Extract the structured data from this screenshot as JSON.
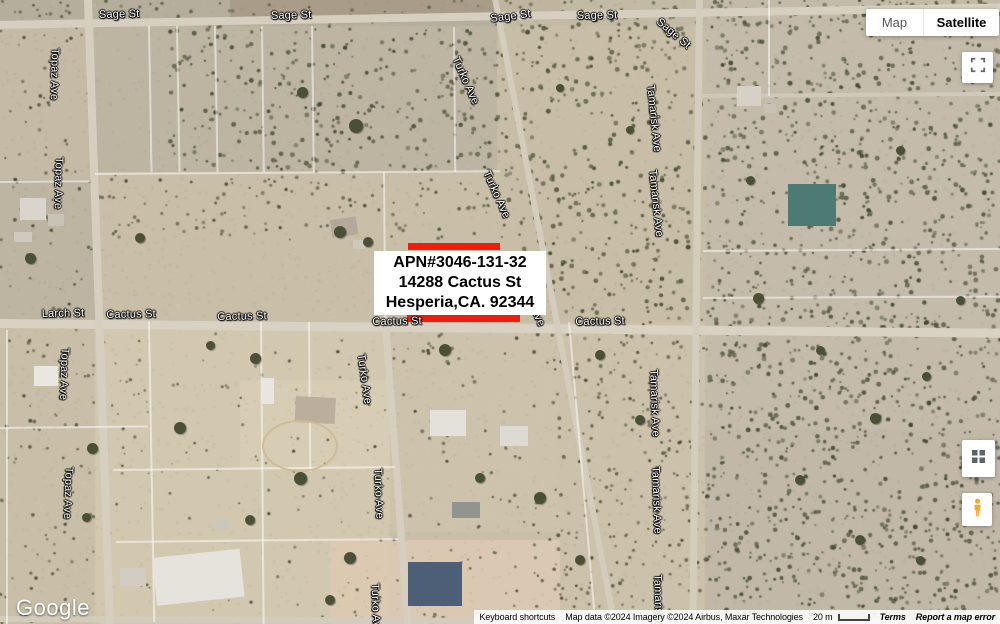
{
  "controls": {
    "map_type": {
      "map": "Map",
      "satellite": "Satellite"
    }
  },
  "overlay": {
    "line1": "APN#3046-131-32",
    "line2": "14288 Cactus St",
    "line3": "Hesperia,CA. 92344"
  },
  "footer": {
    "logo": "Google",
    "keyboard_shortcuts": "Keyboard shortcuts",
    "attribution": "Map data ©2024 Imagery ©2024 Airbus, Maxar Technologies",
    "scale": "20 m",
    "terms": "Terms",
    "report": "Report a map error"
  },
  "colors": {
    "highlight_red": "#f01c0e",
    "label_box_bg": "#ffffff",
    "label_text": "#000000",
    "terrain_base": "#c9bfa9",
    "road": "#d6cfc0",
    "pegman_yellow": "#f9a825",
    "icon_gray": "#5f6368"
  },
  "streets": [
    {
      "text": "Sage St",
      "x": 119,
      "y": 15,
      "rot": -1.5
    },
    {
      "text": "Sage St",
      "x": 291,
      "y": 16,
      "rot": -1.5
    },
    {
      "text": "Sage St",
      "x": 510,
      "y": 19,
      "rot": -7
    },
    {
      "text": "Sage St",
      "x": 597,
      "y": 16,
      "rot": -1
    },
    {
      "text": "Sage St",
      "x": 682,
      "y": 22,
      "rot": 40
    },
    {
      "text": "Topaz Ave",
      "x": 87,
      "y": 54,
      "rot": 91
    },
    {
      "text": "Topaz Ave",
      "x": 91,
      "y": 163,
      "rot": 91
    },
    {
      "text": "Topaz Ave",
      "x": 97,
      "y": 354,
      "rot": 92
    },
    {
      "text": "Topaz Ave",
      "x": 101,
      "y": 473,
      "rot": 92
    },
    {
      "text": "Turko Ave",
      "x": 486,
      "y": 61,
      "rot": 66
    },
    {
      "text": "Turko Ave",
      "x": 517,
      "y": 175,
      "rot": 66
    },
    {
      "text": "Turko Ave",
      "x": 552,
      "y": 283,
      "rot": 66
    },
    {
      "text": "Larch St",
      "x": 63,
      "y": 314,
      "rot": -1
    },
    {
      "text": "Cactus St",
      "x": 131,
      "y": 315,
      "rot": -1
    },
    {
      "text": "Cactus St",
      "x": 242,
      "y": 317,
      "rot": -1
    },
    {
      "text": "Cactus St",
      "x": 397,
      "y": 322,
      "rot": -1
    },
    {
      "text": "Cactus St",
      "x": 600,
      "y": 322,
      "rot": -1
    },
    {
      "text": "Turko Ave",
      "x": 392,
      "y": 359,
      "rot": 82
    },
    {
      "text": "Turko Ave",
      "x": 409,
      "y": 474,
      "rot": 88
    },
    {
      "text": "Turko Ave",
      "x": 406,
      "y": 589,
      "rot": 88
    },
    {
      "text": "Tamarisk Ave",
      "x": 690,
      "y": 90,
      "rot": 84
    },
    {
      "text": "Tamarisk Ave",
      "x": 692,
      "y": 175,
      "rot": 84
    },
    {
      "text": "Tamarisk Ave",
      "x": 693,
      "y": 375,
      "rot": 88
    },
    {
      "text": "Tamarisk Ave",
      "x": 695,
      "y": 472,
      "rot": 88
    },
    {
      "text": "Tamarisk Ave",
      "x": 697,
      "y": 580,
      "rot": 88
    }
  ],
  "map_features": {
    "roads": [
      {
        "x": -5,
        "y": 21,
        "len": 1012,
        "w": 8,
        "rot": -1.0,
        "c": "#d6cfc0"
      },
      {
        "x": -5,
        "y": 319,
        "len": 1012,
        "w": 9,
        "rot": 0.55,
        "c": "#d9d2c3"
      },
      {
        "x": -5,
        "y": 616,
        "len": 1012,
        "w": 6,
        "rot": 0.2,
        "c": "#d3ccbd"
      },
      {
        "x": 92,
        "y": -2,
        "len": 630,
        "w": 8,
        "rot": 88.0,
        "c": "#d6cfc0"
      },
      {
        "x": 498,
        "y": -2,
        "len": 640,
        "w": 6,
        "rot": 79.2,
        "c": "#d4cdbd"
      },
      {
        "x": 389,
        "y": 322,
        "len": 304,
        "w": 7,
        "rot": 85.8,
        "c": "#d6cfc0"
      },
      {
        "x": 703,
        "y": -2,
        "len": 630,
        "w": 7,
        "rot": 90.6,
        "c": "#d4cdbe"
      },
      {
        "x": 700,
        "y": 94,
        "len": 302,
        "w": 4,
        "rot": -0.4,
        "c": "#d0c9ba"
      }
    ],
    "parcel_lines": [
      {
        "x": 150,
        "y": 26,
        "len": 146,
        "rot": 89
      },
      {
        "x": 178,
        "y": 26,
        "len": 146,
        "rot": 89
      },
      {
        "x": 216,
        "y": 26,
        "len": 146,
        "rot": 89
      },
      {
        "x": 263,
        "y": 26,
        "len": 146,
        "rot": 89.3
      },
      {
        "x": 313,
        "y": 26,
        "len": 146,
        "rot": 89.3
      },
      {
        "x": 455,
        "y": 27,
        "len": 145,
        "rot": 89.5
      },
      {
        "x": 95,
        "y": 173,
        "len": 405,
        "rot": -0.4
      },
      {
        "x": 385,
        "y": 172,
        "len": 150,
        "rot": 89.5
      },
      {
        "x": 0,
        "y": 181,
        "len": 90,
        "rot": -0.5
      },
      {
        "x": 703,
        "y": 250,
        "len": 298,
        "rot": -0.4
      },
      {
        "x": 703,
        "y": 297,
        "len": 298,
        "rot": -0.3
      },
      {
        "x": 770,
        "y": 0,
        "len": 96,
        "rot": 90
      },
      {
        "x": 150,
        "y": 322,
        "len": 300,
        "rot": 89
      },
      {
        "x": 262,
        "y": 322,
        "len": 302,
        "rot": 89.5
      },
      {
        "x": 310,
        "y": 322,
        "len": 150,
        "rot": 89.5
      },
      {
        "x": 0,
        "y": 427,
        "len": 148,
        "rot": -0.6
      },
      {
        "x": 113,
        "y": 469,
        "len": 282,
        "rot": -0.6
      },
      {
        "x": 116,
        "y": 541,
        "len": 282,
        "rot": -0.6
      },
      {
        "x": 8,
        "y": 330,
        "len": 294,
        "rot": 90
      },
      {
        "x": 570,
        "y": 322,
        "len": 302,
        "rot": 85
      }
    ],
    "buildings": [
      {
        "x": 20,
        "y": 198,
        "w": 26,
        "h": 22,
        "c": "#dad5cc",
        "rot": 0
      },
      {
        "x": 48,
        "y": 214,
        "w": 16,
        "h": 12,
        "c": "#c9c2b6",
        "rot": 0
      },
      {
        "x": 14,
        "y": 232,
        "w": 18,
        "h": 10,
        "c": "#cfc9bf",
        "rot": 0
      },
      {
        "x": 330,
        "y": 220,
        "w": 26,
        "h": 18,
        "c": "#b3a899",
        "rot": -8
      },
      {
        "x": 353,
        "y": 240,
        "w": 12,
        "h": 9,
        "c": "#cfc8bb",
        "rot": 0
      },
      {
        "x": 737,
        "y": 86,
        "w": 24,
        "h": 20,
        "c": "#d6d0c6",
        "rot": 0
      },
      {
        "x": 764,
        "y": 104,
        "w": 12,
        "h": 9,
        "c": "#c8c1b4",
        "rot": 0
      },
      {
        "x": 788,
        "y": 184,
        "w": 48,
        "h": 42,
        "c": "#4d7a72",
        "rot": 0
      },
      {
        "x": 296,
        "y": 396,
        "w": 40,
        "h": 26,
        "c": "#bcae9d",
        "rot": 3
      },
      {
        "x": 262,
        "y": 378,
        "w": 12,
        "h": 26,
        "c": "#e9e6e1",
        "rot": 0
      },
      {
        "x": 430,
        "y": 410,
        "w": 36,
        "h": 26,
        "c": "#e4e1db",
        "rot": 0
      },
      {
        "x": 500,
        "y": 426,
        "w": 28,
        "h": 20,
        "c": "#dddad3",
        "rot": 0
      },
      {
        "x": 452,
        "y": 502,
        "w": 28,
        "h": 16,
        "c": "#90958f",
        "rot": 0
      },
      {
        "x": 408,
        "y": 562,
        "w": 54,
        "h": 44,
        "c": "#4d5f76",
        "rot": 0
      },
      {
        "x": 152,
        "y": 558,
        "w": 88,
        "h": 48,
        "c": "#e6e3dd",
        "rot": -6
      },
      {
        "x": 34,
        "y": 366,
        "w": 24,
        "h": 20,
        "c": "#eae7e1",
        "rot": 0
      },
      {
        "x": 120,
        "y": 568,
        "w": 26,
        "h": 18,
        "c": "#d2ccc2",
        "rot": 0
      },
      {
        "x": 216,
        "y": 520,
        "w": 14,
        "h": 10,
        "c": "#cdc6ba",
        "rot": 0
      },
      {
        "x": 262,
        "y": 420,
        "w": 72,
        "h": 48,
        "c": "transparent",
        "rot": 0,
        "el": 1
      }
    ],
    "trees": [
      [
        356,
        126,
        14
      ],
      [
        302,
        92,
        11
      ],
      [
        340,
        232,
        12
      ],
      [
        368,
        242,
        10
      ],
      [
        445,
        350,
        12
      ],
      [
        255,
        358,
        11
      ],
      [
        600,
        355,
        10
      ],
      [
        92,
        448,
        11
      ],
      [
        180,
        428,
        12
      ],
      [
        300,
        478,
        13
      ],
      [
        540,
        498,
        12
      ],
      [
        758,
        298,
        11
      ],
      [
        875,
        418,
        11
      ],
      [
        926,
        376,
        9
      ],
      [
        350,
        558,
        12
      ],
      [
        30,
        258,
        11
      ],
      [
        140,
        238,
        10
      ],
      [
        480,
        478,
        10
      ],
      [
        640,
        420,
        10
      ],
      [
        580,
        560,
        10
      ],
      [
        860,
        540,
        10
      ],
      [
        800,
        480,
        10
      ],
      [
        920,
        560,
        9
      ],
      [
        820,
        350,
        9
      ],
      [
        960,
        300,
        9
      ],
      [
        900,
        150,
        9
      ],
      [
        750,
        180,
        9
      ],
      [
        630,
        130,
        8
      ],
      [
        560,
        88,
        8
      ],
      [
        210,
        345,
        9
      ],
      [
        250,
        520,
        10
      ],
      [
        330,
        600,
        10
      ],
      [
        86,
        517,
        9
      ]
    ],
    "highlight_bars": [
      {
        "x": 408,
        "y": 243,
        "w": 92,
        "h": 7
      },
      {
        "x": 407,
        "y": 315,
        "w": 113,
        "h": 7
      }
    ]
  }
}
